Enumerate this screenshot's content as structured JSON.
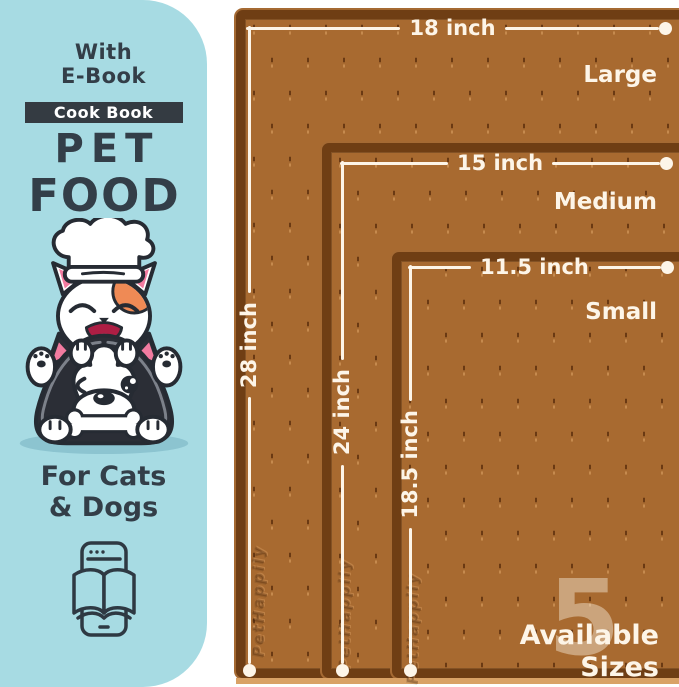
{
  "panel": {
    "bg_color": "#a7dbe3",
    "text_color": "#333e48",
    "ebook_line1": "With",
    "ebook_line2": "E-Book",
    "badge_label": "Cook Book",
    "title_line1": "PET",
    "title_line2": "FOOD",
    "audience_line1": "For Cats",
    "audience_line2": "& Dogs"
  },
  "mats": {
    "surface_color": "#a86a30",
    "rim_color": "#6f3e14",
    "line_color": "#fdf5e8",
    "watermark": "PetHappily",
    "sizes": [
      {
        "name": "Large",
        "width_label": "18 inch",
        "height_label": "28 inch"
      },
      {
        "name": "Medium",
        "width_label": "15 inch",
        "height_label": "24 inch"
      },
      {
        "name": "Small",
        "width_label": "11.5 inch",
        "height_label": "18.5 inch"
      }
    ]
  },
  "sizes_badge": {
    "count": "5",
    "line1": "Available",
    "line2": "Sizes"
  }
}
